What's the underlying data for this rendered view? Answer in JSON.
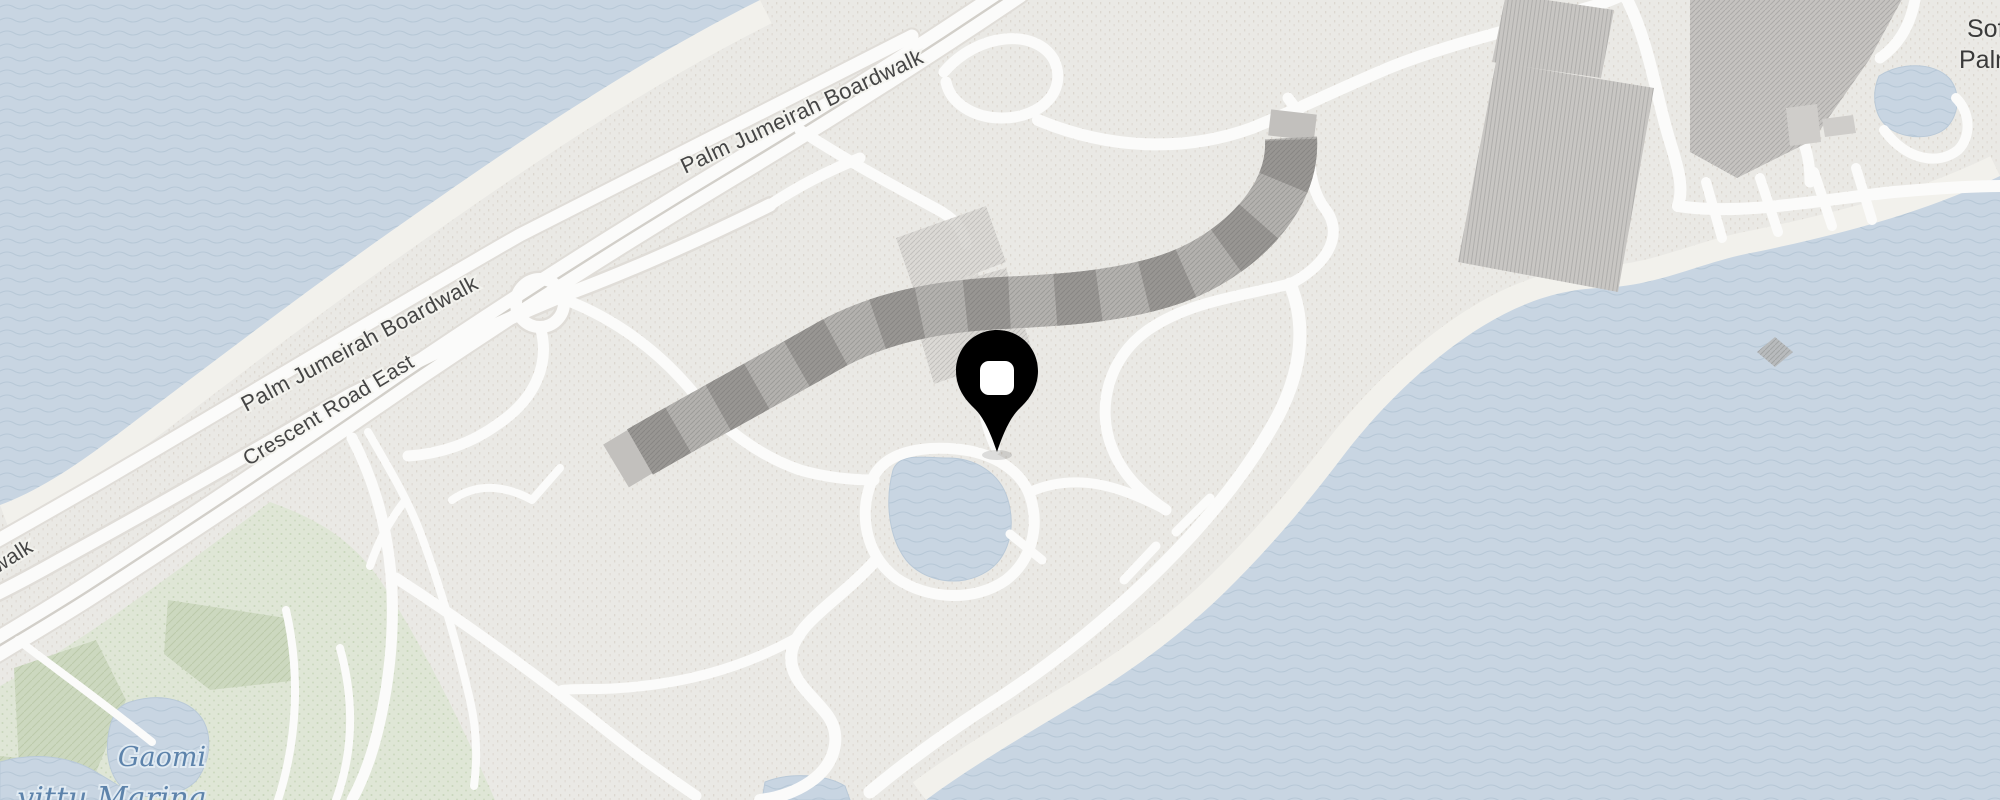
{
  "map": {
    "road_labels": {
      "boardwalk_top": "Palm Jumeirah Boardwalk",
      "boardwalk_mid": "Palm Jumeirah Boardwalk",
      "boardwalk_fragment": "walk",
      "crescent_road_east": "Crescent Road East"
    },
    "water_labels": {
      "gaomi": "Gaomi",
      "partial_bottom": "vittu Marina"
    },
    "poi_labels": {
      "line1": "Sof",
      "line2": "Palm"
    },
    "marker": {
      "type": "location-pin",
      "fill": "#000000",
      "center": "#ffffff"
    },
    "colors": {
      "water": "#c8d5e2",
      "water_wave": "#b7c8d7",
      "land": "#eae9e5",
      "park": "#dfe6d6",
      "hedge": "#ccd8bf",
      "beach": "#f2f1ec",
      "road": "#fbfbfa",
      "road_casing": "#dfdcd7",
      "building_dark": "#989693",
      "building_mid": "#b3b1ae",
      "building_light": "#d9d7d3",
      "road_label": "#454545",
      "water_label": "#5d83ab",
      "poi_label": "#3a3a3a"
    }
  }
}
